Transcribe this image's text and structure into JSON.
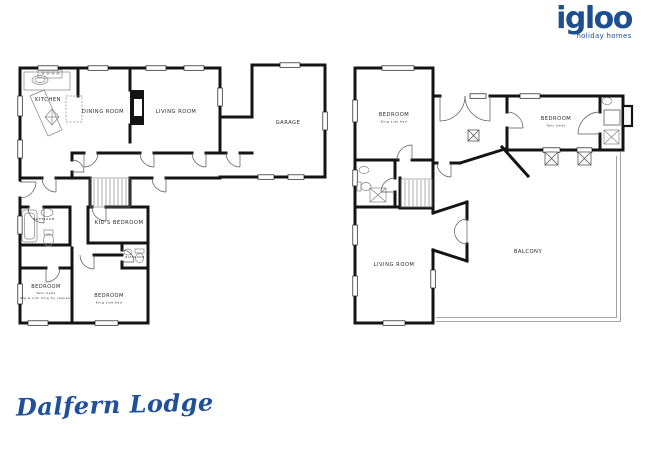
{
  "logo": {
    "brand": "igloo",
    "tagline": "holiday homes"
  },
  "property_name": "Dalfern Lodge",
  "colors": {
    "brand_navy": "#1d4e8f",
    "wall_black": "#141414"
  },
  "ground_floor": {
    "kitchen": "KITCHEN",
    "dining_room": "DINING ROOM",
    "living_room": "LIVING ROOM",
    "garage": "GARAGE",
    "bathroom": "BATHROOM",
    "kids_bedroom": "KID'S BEDROOM",
    "ensuite": "BATHROOM",
    "bedroom_twin": {
      "title": "BEDROOM",
      "line1": "Twin beds",
      "line2": "Zip & link king by request"
    },
    "bedroom_king": {
      "title": "BEDROOM",
      "line1": "King size bed"
    }
  },
  "first_floor": {
    "bedroom_king": {
      "title": "BEDROOM",
      "line1": "King size bed"
    },
    "bedroom_twin": {
      "title": "BEDROOM",
      "line1": "Twin beds"
    },
    "living_room": "LIVING ROOM",
    "balcony": "BALCONY"
  }
}
